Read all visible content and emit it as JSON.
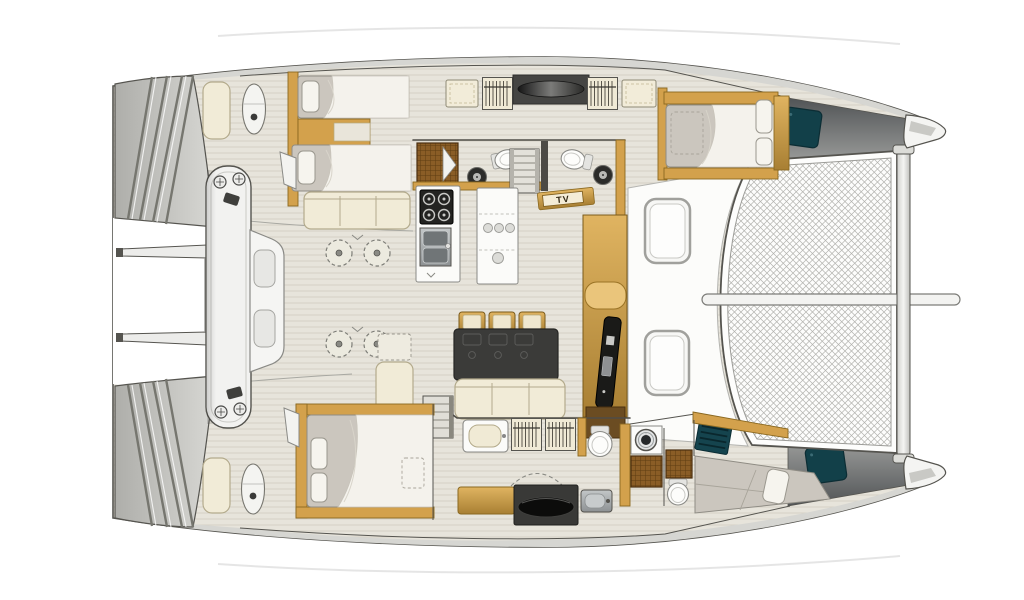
{
  "figure": {
    "type": "catamaran-interior-deck-plan",
    "orientation": "bow-right",
    "labels": {
      "tv": "TV"
    },
    "decks": {
      "port_hull": [
        "twin-guest-cabin",
        "head-with-shower",
        "hanging-lockers",
        "double-bed-cabin-forward"
      ],
      "bridge_deck": [
        "galley-with-stove-and-double-sink",
        "island-counter",
        "dinette-table-with-three-chairs",
        "settee",
        "tv-cabinet",
        "companionway-stairs",
        "bar-stools"
      ],
      "starboard_hull": [
        "aft-double-cabin",
        "vanity-and-hanging-lockers",
        "head",
        "utility-room-washer-and-shower",
        "crew-berth-bow"
      ],
      "exterior": [
        "transom-steps",
        "stern-benches",
        "davit-arms",
        "davit-arch",
        "foredeck-hatches",
        "anchor-locker-hatches",
        "trampoline-net",
        "forward-crossbeam",
        "bowsprit-seam"
      ]
    }
  },
  "palette": {
    "outline": "#55544f",
    "deck_band": "#d6d6d2",
    "steps_light": "#d8d8d4",
    "steps_dark": "#aeaeaa",
    "floor": "#e7e4db",
    "floor_line": "#d4cfc2",
    "wood": "#d3a14c",
    "wood_dark": "#8a6820",
    "wood_light": "#eac57b",
    "cream": "#f1ebd7",
    "cream_edge": "#b3aa8c",
    "mattress": "#cbc6be",
    "mattress_edge": "#8f8c84",
    "duvet": "#f4f2ec",
    "fixture_white": "#fcfcfa",
    "fixture_edge": "#8a8a86",
    "table_dark": "#3b3b39",
    "charcoal": "#454543",
    "teal_hatch": "#124049",
    "shower_brown": "#8a5d26",
    "shower_line": "#5e3d12",
    "steel": "#aeb2b4",
    "net_line": "#b2b2ae",
    "bow_deck_dark": "#515456",
    "bow_deck_light": "#a3a4a2",
    "white": "#ffffff"
  }
}
